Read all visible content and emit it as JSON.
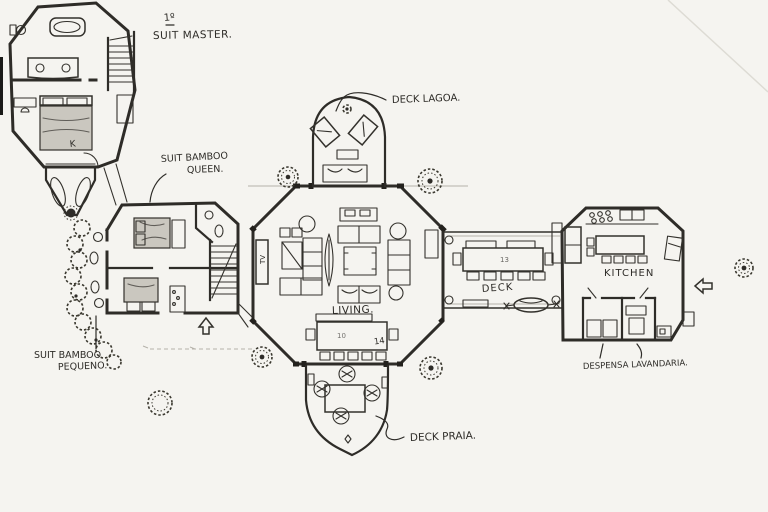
{
  "document": {
    "type": "hand-drawn floor plan sketch",
    "floor": "first floor of a multi-pavilion house"
  },
  "labels": {
    "floor_number": "1º",
    "suit_master": "SUIT MASTER.",
    "suit_bamboo_queen_1": "SUIT BAMBOO",
    "suit_bamboo_queen_2": "QUEEN.",
    "suit_bamboo_pequeno_1": "SUIT BAMBOO",
    "suit_bamboo_pequeno_2": "PEQUENO.",
    "deck_lagoa": "DECK LAGOA.",
    "living": "LIVING.",
    "deck": "DECK",
    "kitchen": "KITCHEN",
    "deck_praia": "DECK PRAIA.",
    "despensa_lavandaria": "DESPENSA LAVANDARIA."
  },
  "annotations": {
    "bed_king": "K",
    "tv": "TV",
    "living_table_mark_a": "10",
    "living_table_mark_b": "14",
    "deck_table_mark": "13"
  },
  "colors": {
    "paper": "#f5f4f0",
    "ink": "#2e2c28",
    "pencil": "#b5b2aa",
    "bed_shading": "#cac7bf"
  }
}
